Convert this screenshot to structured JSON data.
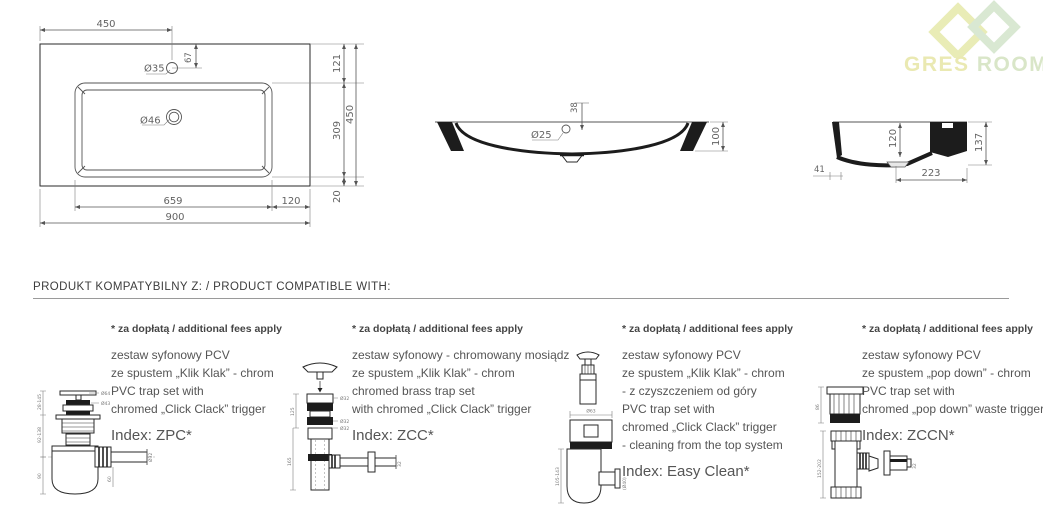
{
  "logo": {
    "word1": "GRES",
    "word2": "ROOM"
  },
  "section_heading": "PRODUKT KOMPATYBILNY Z: / PRODUCT COMPATIBLE WITH:",
  "views": {
    "top": {
      "width_total": "900",
      "width_bowl": "659",
      "width_right": "120",
      "dist_faucet": "450",
      "faucet_offset": "67",
      "faucet_hole": "Ø35",
      "drain_hole": "Ø46",
      "depth_top": "121",
      "depth_bowl": "309",
      "depth_total": "450",
      "depth_bottom": "20"
    },
    "front": {
      "overflow_depth": "38",
      "overflow_hole": "Ø25",
      "height": "100"
    },
    "side": {
      "bowl_depth": "120",
      "height": "137",
      "front_edge": "41",
      "bottom_width": "223"
    }
  },
  "products": [
    {
      "note": "* za dopłatą / additional fees apply",
      "lines": [
        "zestaw syfonowy PCV",
        "ze spustem „Klik Klak” - chrom",
        "PVC trap set with",
        "chromed „Click Clack” trigger"
      ],
      "index": "Index: ZPC*",
      "dims": [
        "28-145",
        "92-138",
        "90",
        "60",
        "Ø64",
        "Ø43",
        "Ø32"
      ]
    },
    {
      "note": "* za dopłatą / additional fees apply",
      "lines": [
        "zestaw syfonowy - chromowany mosiądz",
        "ze spustem „Klik Klak” - chrom",
        "chromed brass trap set",
        "with chromed „Click Clack” trigger"
      ],
      "index": "Index: ZCC*",
      "dims": [
        "125",
        "165",
        "Ø32",
        "Ø32",
        "Ø32",
        "32"
      ]
    },
    {
      "note": "* za dopłatą / additional fees apply",
      "lines": [
        "zestaw syfonowy PCV",
        "ze spustem „Klik Klak” - chrom",
        "- z czyszczeniem od góry",
        "PVC trap set with",
        "chromed „Click Clack” trigger",
        "- cleaning from the top system"
      ],
      "index": "Index: Easy Clean*",
      "dims": [
        "Ø63",
        "105-143",
        "(Ø40)"
      ]
    },
    {
      "note": "* za dopłatą / additional fees apply",
      "lines": [
        "zestaw syfonowy PCV",
        "ze spustem „pop down” - chrom",
        "PVC trap set with",
        "chromed „pop down” waste trigger"
      ],
      "index": "Index: ZCCN*",
      "dims": [
        "86",
        "152-202",
        "32"
      ]
    }
  ]
}
